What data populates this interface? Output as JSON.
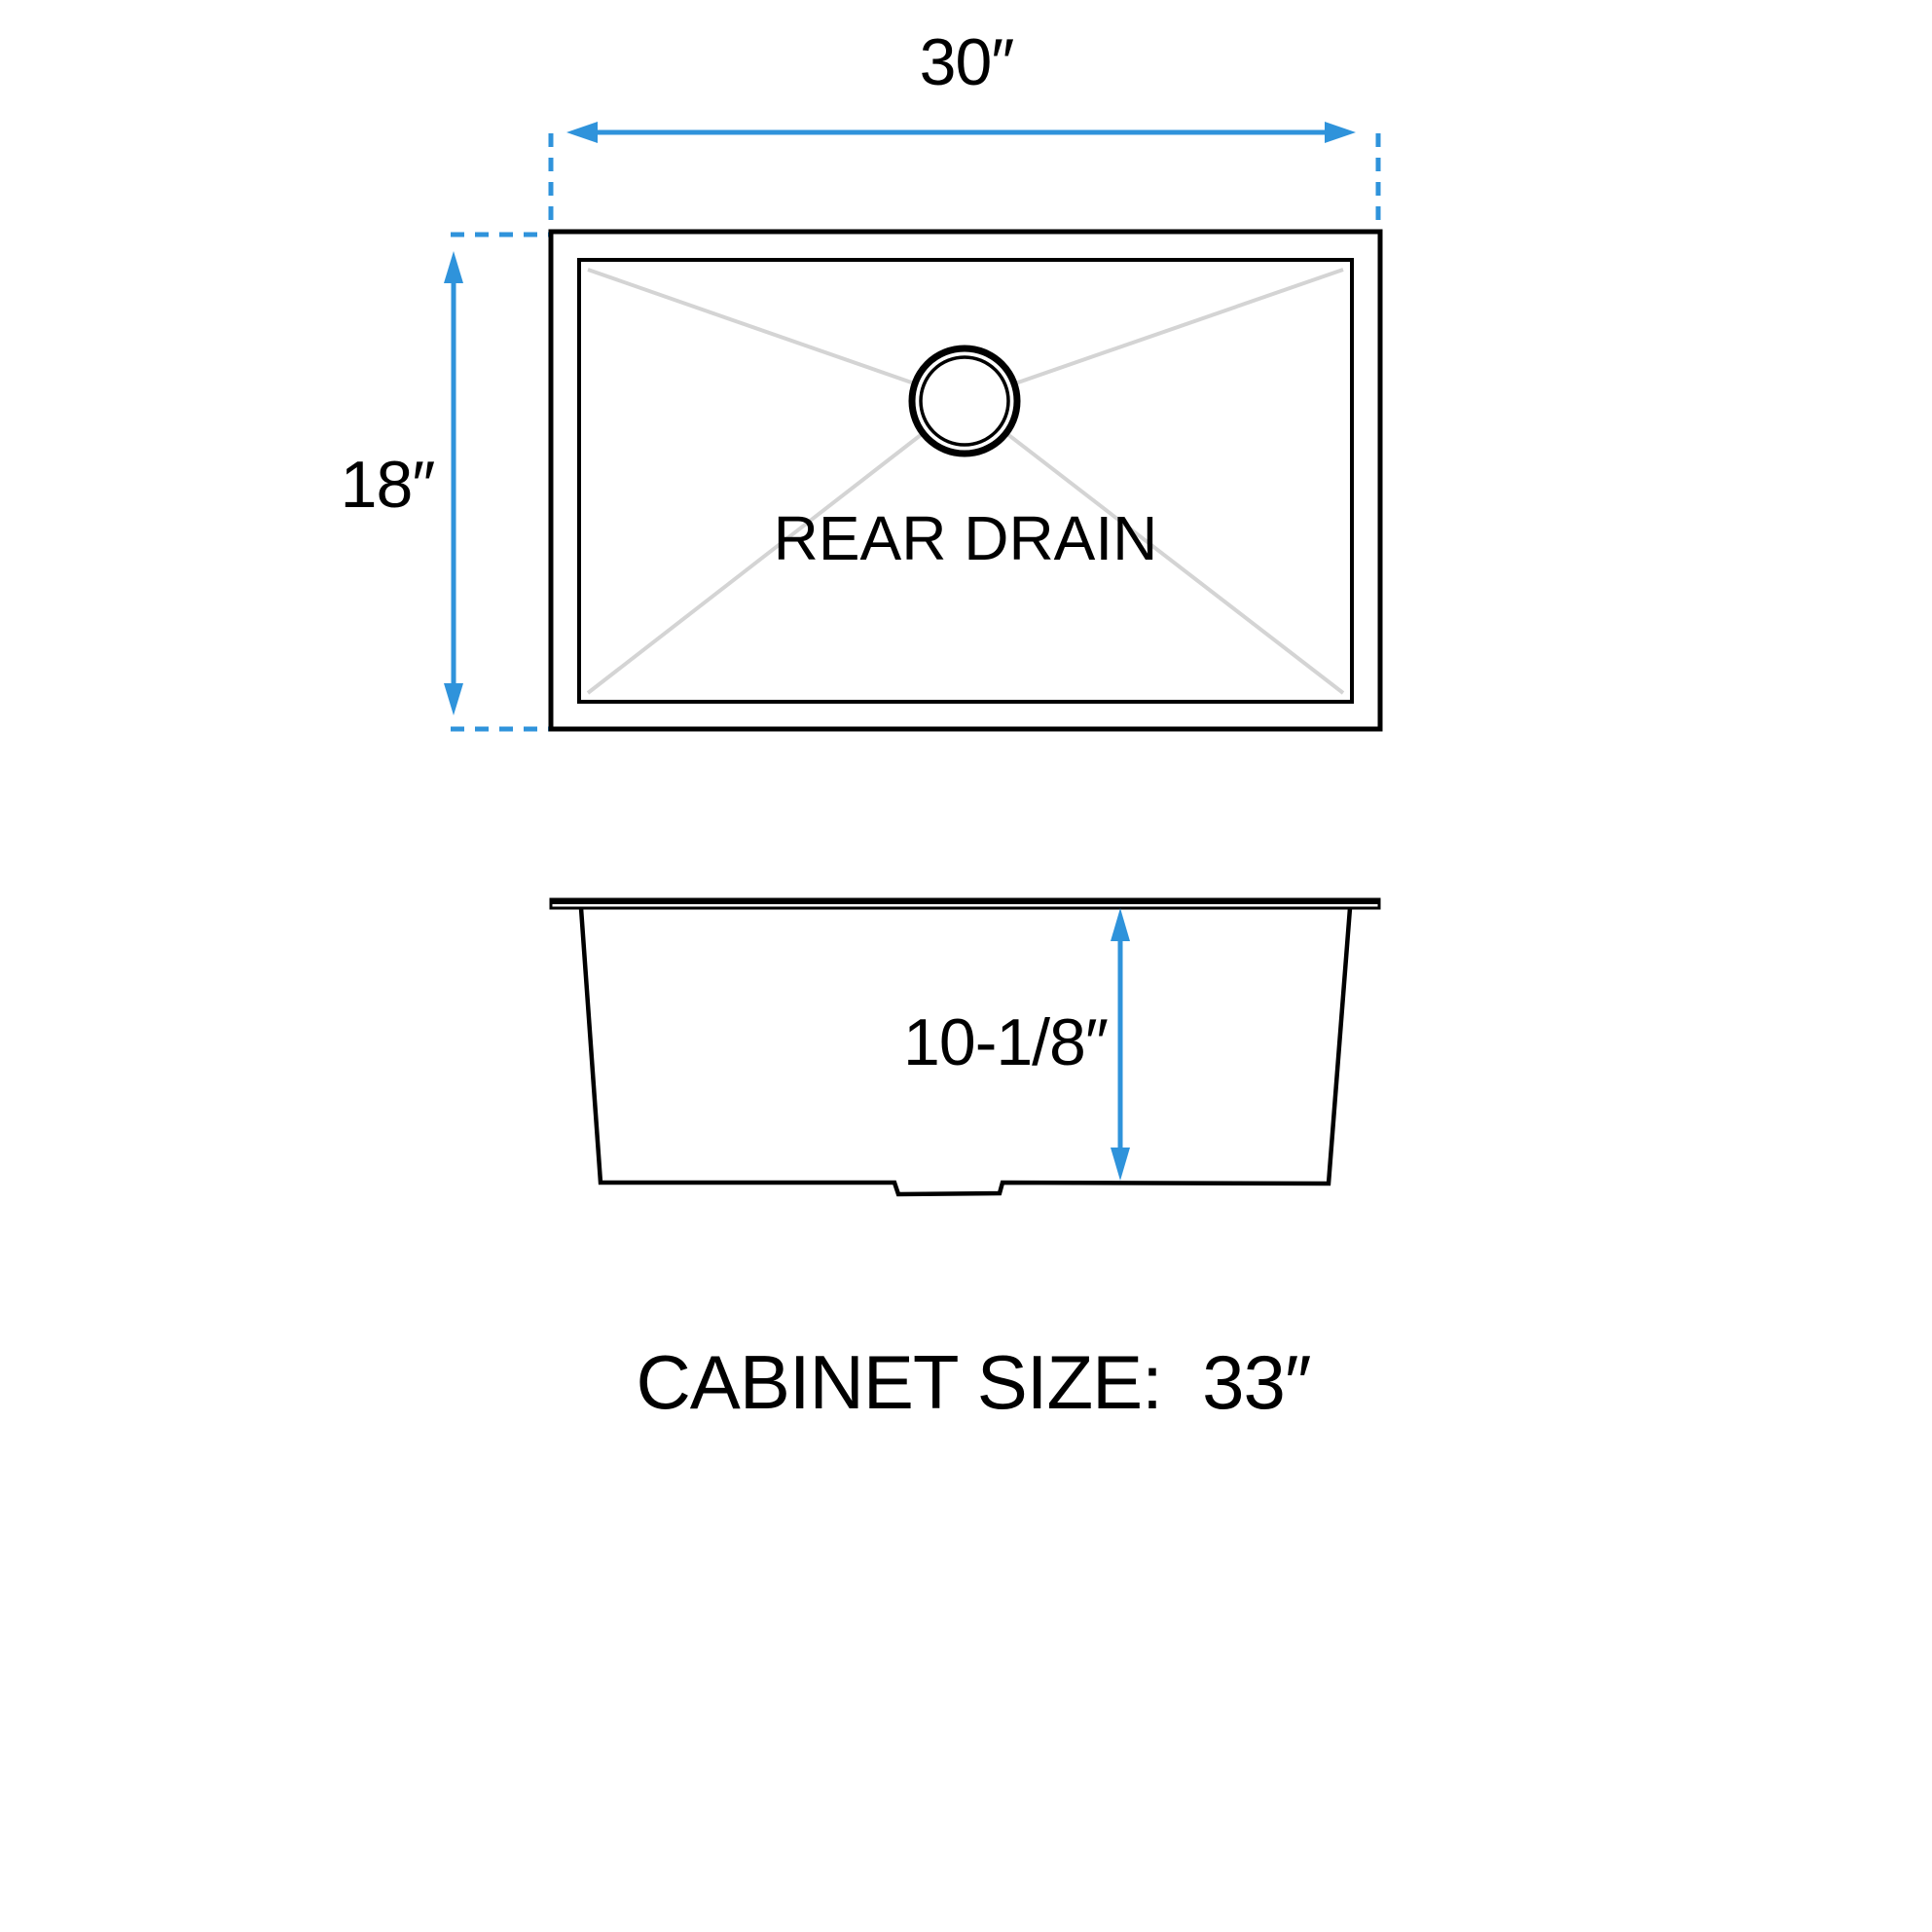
{
  "diagram": {
    "kind": "sink-dimension-diagram",
    "top_view": {
      "width_label": "30″",
      "depth_label": "18″",
      "drain_label": "REAR DRAIN"
    },
    "side_view": {
      "height_label": "10-1/8″"
    },
    "caption": "CABINET SIZE:  33″"
  },
  "colors": {
    "accent_blue": "#2F93DB",
    "line_black": "#000000",
    "diagonal_gray": "#D4D4D4",
    "background": "#FFFFFF"
  }
}
